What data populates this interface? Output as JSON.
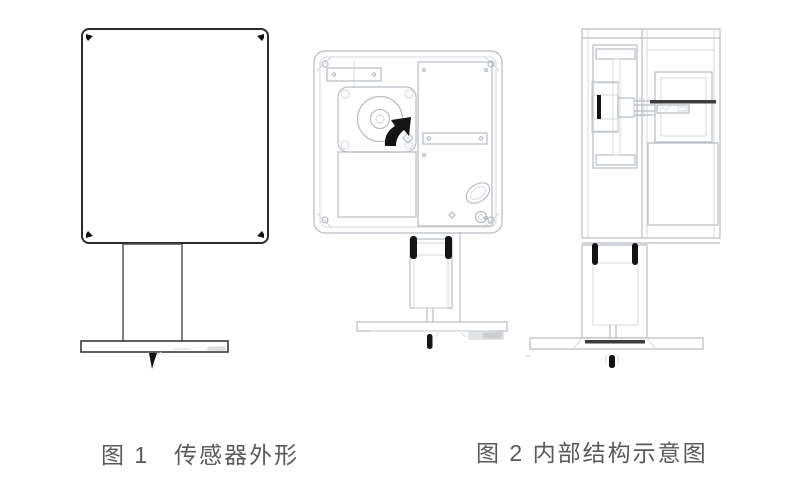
{
  "window": {
    "width": 800,
    "height": 500,
    "background": "#ffffff"
  },
  "figures": {
    "figure1": {
      "caption": "图 1　传感器外形"
    },
    "figure2": {
      "caption": "图 2 内部结构示意图"
    }
  },
  "colors": {
    "page_bg": "#ffffff",
    "line_dark": "#2b2b2b",
    "line_light": "#b6bcc2",
    "line_faint": "#d2d6da",
    "accent_black": "#141414",
    "shaft_dark": "#3c3c3c",
    "hatch_dot": "#a7adb4",
    "caption_text": "#595959",
    "watermark_gray": "#c4c8cc"
  }
}
